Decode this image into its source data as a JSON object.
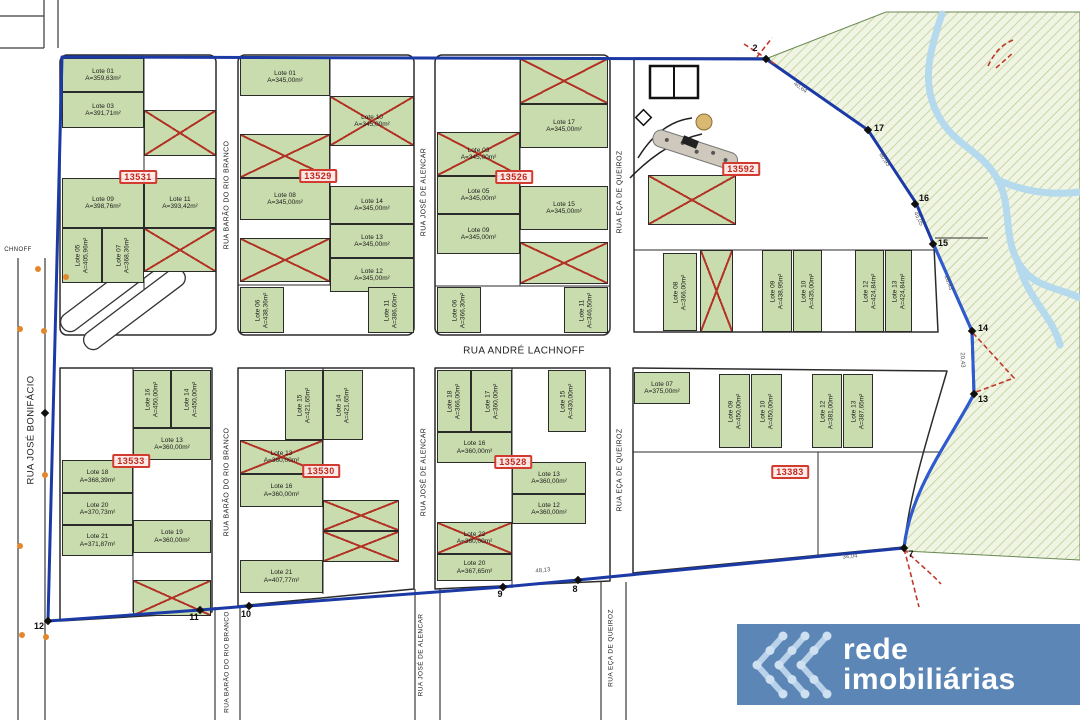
{
  "map": {
    "colors": {
      "boundary_blue": "#1b3aa6",
      "boundary_blue_bright": "#2e5bd0",
      "lot_green": "#c9dcad",
      "cross_red": "#b23326",
      "tag_red": "#d23b2f",
      "hatch_bg": "#f0f4e3",
      "hatch_line": "#bccf96",
      "river_blue": "#b5d9ed",
      "logo_bg": "#5b86b6",
      "logo_chevron": "#b9d2ea",
      "dot_orange": "#e2882a"
    },
    "streets": [
      "RUA JOSÉ BONIFÁCIO",
      "RUA BARÃO DO RIO BRANCO",
      "RUA JOSÉ DE ALENCAR",
      "RUA EÇA DE QUEIROZ",
      "RUA ANDRÉ LACHNOFF"
    ],
    "street_labels": [
      {
        "t": "RUA BARÃO DO RIO BRANCO",
        "x": 227,
        "y": 195,
        "v": true,
        "s": 7
      },
      {
        "t": "RUA BARÃO DO RIO BRANCO",
        "x": 227,
        "y": 482,
        "v": true,
        "s": 7
      },
      {
        "t": "RUA BARÃO DO RIO BRANCO",
        "x": 227,
        "y": 662,
        "v": true,
        "s": 6.5
      },
      {
        "t": "RUA JOSÉ DE ALENCAR",
        "x": 424,
        "y": 192,
        "v": true,
        "s": 7
      },
      {
        "t": "RUA JOSÉ DE ALENCAR",
        "x": 424,
        "y": 472,
        "v": true,
        "s": 7
      },
      {
        "t": "RUA JOSÉ DE ALENCAR",
        "x": 421,
        "y": 655,
        "v": true,
        "s": 6.5
      },
      {
        "t": "RUA EÇA DE QUEIROZ",
        "x": 620,
        "y": 192,
        "v": true,
        "s": 7
      },
      {
        "t": "RUA EÇA DE QUEIROZ",
        "x": 620,
        "y": 470,
        "v": true,
        "s": 7
      },
      {
        "t": "RUA EÇA DE QUEIROZ",
        "x": 611,
        "y": 648,
        "v": true,
        "s": 6.5
      },
      {
        "t": "RUA JOSÉ BONIFÁCIO",
        "x": 31,
        "y": 430,
        "v": true,
        "s": 9.5
      },
      {
        "t": "RUA ANDRÉ LACHNOFF",
        "x": 524,
        "y": 351,
        "v": false,
        "s": 10
      },
      {
        "t": "CHNOFF",
        "x": 18,
        "y": 250,
        "v": false,
        "s": 6
      }
    ],
    "lots": [
      {
        "x": 62,
        "y": 58,
        "w": 82,
        "h": 34,
        "n": "Lote 01",
        "a": "A=359,63m²"
      },
      {
        "x": 62,
        "y": 92,
        "w": 82,
        "h": 36,
        "n": "Lote 03",
        "a": "A=391,71m²"
      },
      {
        "x": 144,
        "y": 110,
        "w": 72,
        "h": 46,
        "n": "",
        "a": "",
        "c": true
      },
      {
        "x": 62,
        "y": 178,
        "w": 82,
        "h": 50,
        "n": "Lote 09",
        "a": "A=398,76m²"
      },
      {
        "x": 144,
        "y": 178,
        "w": 72,
        "h": 50,
        "n": "Lote 11",
        "a": "A=393,42m²"
      },
      {
        "x": 144,
        "y": 228,
        "w": 72,
        "h": 44,
        "n": "",
        "a": "",
        "c": true
      },
      {
        "x": 62,
        "y": 228,
        "w": 40,
        "h": 55,
        "n": "Lote 05",
        "a": "A=405,96m²",
        "v": true
      },
      {
        "x": 102,
        "y": 228,
        "w": 42,
        "h": 55,
        "n": "Lote 07",
        "a": "A=368,36m²",
        "v": true
      },
      {
        "x": 240,
        "y": 58,
        "w": 90,
        "h": 38,
        "n": "Lote 01",
        "a": "A=345,00m²"
      },
      {
        "x": 330,
        "y": 96,
        "w": 84,
        "h": 50,
        "n": "Lote 10",
        "a": "A=345,00m²",
        "c": true
      },
      {
        "x": 240,
        "y": 134,
        "w": 90,
        "h": 44,
        "n": "",
        "a": "",
        "c": true
      },
      {
        "x": 240,
        "y": 178,
        "w": 90,
        "h": 42,
        "n": "Lote 08",
        "a": "A=345,00m²"
      },
      {
        "x": 330,
        "y": 186,
        "w": 84,
        "h": 38,
        "n": "Lote 14",
        "a": "A=345,00m²"
      },
      {
        "x": 330,
        "y": 224,
        "w": 84,
        "h": 34,
        "n": "Lote 13",
        "a": "A=345,00m²"
      },
      {
        "x": 330,
        "y": 258,
        "w": 84,
        "h": 34,
        "n": "Lote 12",
        "a": "A=345,00m²"
      },
      {
        "x": 240,
        "y": 238,
        "w": 90,
        "h": 44,
        "n": "",
        "a": "",
        "c": true
      },
      {
        "x": 240,
        "y": 287,
        "w": 44,
        "h": 46,
        "n": "Lote 06",
        "a": "A=438,36m²",
        "v": true
      },
      {
        "x": 368,
        "y": 287,
        "w": 46,
        "h": 46,
        "n": "Lote 11",
        "a": "A=386,60m²",
        "v": true
      },
      {
        "x": 520,
        "y": 58,
        "w": 88,
        "h": 46,
        "n": "",
        "a": "",
        "c": true
      },
      {
        "x": 520,
        "y": 104,
        "w": 88,
        "h": 44,
        "n": "Lote 17",
        "a": "A=345,00m²"
      },
      {
        "x": 437,
        "y": 132,
        "w": 83,
        "h": 44,
        "n": "Lote 03",
        "a": "A=345,00m²",
        "c": true
      },
      {
        "x": 520,
        "y": 186,
        "w": 88,
        "h": 44,
        "n": "Lote 15",
        "a": "A=345,00m²"
      },
      {
        "x": 437,
        "y": 176,
        "w": 83,
        "h": 38,
        "n": "Lote 05",
        "a": "A=345,00m²"
      },
      {
        "x": 437,
        "y": 214,
        "w": 83,
        "h": 40,
        "n": "Lote 09",
        "a": "A=345,00m²"
      },
      {
        "x": 520,
        "y": 242,
        "w": 88,
        "h": 42,
        "n": "",
        "a": "",
        "c": true
      },
      {
        "x": 437,
        "y": 287,
        "w": 44,
        "h": 46,
        "n": "Lote 06",
        "a": "A=366,30m²",
        "v": true
      },
      {
        "x": 564,
        "y": 287,
        "w": 44,
        "h": 46,
        "n": "Lote 11",
        "a": "A=346,50m²",
        "v": true
      },
      {
        "x": 648,
        "y": 175,
        "w": 88,
        "h": 50,
        "n": "",
        "a": "",
        "c": true
      },
      {
        "x": 663,
        "y": 253,
        "w": 34,
        "h": 78,
        "n": "Lote 08",
        "a": "A=366,00m²",
        "v": true
      },
      {
        "x": 700,
        "y": 250,
        "w": 33,
        "h": 82,
        "n": "",
        "a": "",
        "c": true
      },
      {
        "x": 762,
        "y": 250,
        "w": 30,
        "h": 82,
        "n": "Lote 09",
        "a": "A=438,95m²",
        "v": true
      },
      {
        "x": 793,
        "y": 250,
        "w": 29,
        "h": 82,
        "n": "Lote 10",
        "a": "A=435,00m²",
        "v": true
      },
      {
        "x": 855,
        "y": 250,
        "w": 29,
        "h": 82,
        "n": "Lote 12",
        "a": "A=424,84m²",
        "v": true
      },
      {
        "x": 885,
        "y": 250,
        "w": 27,
        "h": 82,
        "n": "Lote 13",
        "a": "A=424,84m²",
        "v": true
      },
      {
        "x": 133,
        "y": 370,
        "w": 38,
        "h": 58,
        "n": "Lote 16",
        "a": "A=450,00m²",
        "v": true
      },
      {
        "x": 171,
        "y": 370,
        "w": 40,
        "h": 58,
        "n": "Lote 14",
        "a": "A=450,00m²",
        "v": true
      },
      {
        "x": 133,
        "y": 428,
        "w": 78,
        "h": 32,
        "n": "Lote 13",
        "a": "A=360,00m²"
      },
      {
        "x": 62,
        "y": 460,
        "w": 71,
        "h": 33,
        "n": "Lote 18",
        "a": "A=368,39m²"
      },
      {
        "x": 62,
        "y": 493,
        "w": 71,
        "h": 32,
        "n": "Lote 20",
        "a": "A=370,73m²"
      },
      {
        "x": 62,
        "y": 525,
        "w": 71,
        "h": 31,
        "n": "Lote 21",
        "a": "A=371,87m²"
      },
      {
        "x": 133,
        "y": 520,
        "w": 78,
        "h": 33,
        "n": "Lote 19",
        "a": "A=360,00m²"
      },
      {
        "x": 133,
        "y": 580,
        "w": 78,
        "h": 36,
        "n": "",
        "a": "",
        "c": true
      },
      {
        "x": 285,
        "y": 370,
        "w": 38,
        "h": 70,
        "n": "Lote 15",
        "a": "A=421,65m²",
        "v": true
      },
      {
        "x": 323,
        "y": 370,
        "w": 40,
        "h": 70,
        "n": "Lote 14",
        "a": "A=421,65m²",
        "v": true
      },
      {
        "x": 240,
        "y": 440,
        "w": 83,
        "h": 34,
        "n": "Lote 13",
        "a": "A=360,00m²",
        "c": true
      },
      {
        "x": 240,
        "y": 474,
        "w": 83,
        "h": 33,
        "n": "Lote 16",
        "a": "A=360,00m²"
      },
      {
        "x": 323,
        "y": 500,
        "w": 76,
        "h": 31,
        "n": "",
        "a": "",
        "c": true
      },
      {
        "x": 323,
        "y": 531,
        "w": 76,
        "h": 31,
        "n": "",
        "a": "",
        "c": true
      },
      {
        "x": 240,
        "y": 560,
        "w": 83,
        "h": 33,
        "n": "Lote 21",
        "a": "A=407,77m²"
      },
      {
        "x": 437,
        "y": 370,
        "w": 34,
        "h": 62,
        "n": "Lote 18",
        "a": "A=366,00m²",
        "v": true
      },
      {
        "x": 471,
        "y": 370,
        "w": 41,
        "h": 62,
        "n": "Lote 17",
        "a": "A=360,00m²",
        "v": true
      },
      {
        "x": 548,
        "y": 370,
        "w": 38,
        "h": 62,
        "n": "Lote 15",
        "a": "A=430,00m²",
        "v": true
      },
      {
        "x": 437,
        "y": 432,
        "w": 75,
        "h": 31,
        "n": "Lote 16",
        "a": "A=360,00m²"
      },
      {
        "x": 512,
        "y": 462,
        "w": 74,
        "h": 32,
        "n": "Lote 13",
        "a": "A=360,00m²"
      },
      {
        "x": 512,
        "y": 494,
        "w": 74,
        "h": 30,
        "n": "Lote 12",
        "a": "A=360,00m²"
      },
      {
        "x": 437,
        "y": 522,
        "w": 75,
        "h": 32,
        "n": "Lote 22",
        "a": "A=360,00m²",
        "c": true
      },
      {
        "x": 437,
        "y": 554,
        "w": 75,
        "h": 27,
        "n": "Lote 20",
        "a": "A=367,65m²"
      },
      {
        "x": 634,
        "y": 372,
        "w": 56,
        "h": 32,
        "n": "Lote 07",
        "a": "A=375,00m²"
      },
      {
        "x": 719,
        "y": 374,
        "w": 31,
        "h": 74,
        "n": "Lote 09",
        "a": "A=450,00m²",
        "v": true
      },
      {
        "x": 751,
        "y": 374,
        "w": 31,
        "h": 74,
        "n": "Lote 10",
        "a": "A=450,00m²",
        "v": true
      },
      {
        "x": 812,
        "y": 374,
        "w": 30,
        "h": 74,
        "n": "Lote 12",
        "a": "A=381,00m²",
        "v": true
      },
      {
        "x": 843,
        "y": 374,
        "w": 30,
        "h": 74,
        "n": "Lote 13",
        "a": "A=387,65m²",
        "v": true
      }
    ],
    "tags": [
      {
        "t": "13531",
        "x": 138,
        "y": 177
      },
      {
        "t": "13529",
        "x": 318,
        "y": 176
      },
      {
        "t": "13526",
        "x": 514,
        "y": 177
      },
      {
        "t": "13592",
        "x": 741,
        "y": 169
      },
      {
        "t": "13533",
        "x": 131,
        "y": 461
      },
      {
        "t": "13530",
        "x": 321,
        "y": 471
      },
      {
        "t": "13528",
        "x": 513,
        "y": 462
      },
      {
        "t": "13383",
        "x": 790,
        "y": 472
      }
    ],
    "vertices": [
      {
        "n": "2",
        "mx": 766,
        "my": 59,
        "lx": 755,
        "ly": 48
      },
      {
        "n": "17",
        "mx": 868,
        "my": 130,
        "lx": 879,
        "ly": 128
      },
      {
        "n": "16",
        "mx": 915,
        "my": 204,
        "lx": 924,
        "ly": 198
      },
      {
        "n": "15",
        "mx": 933,
        "my": 244,
        "lx": 943,
        "ly": 243
      },
      {
        "n": "14",
        "mx": 972,
        "my": 331,
        "lx": 983,
        "ly": 328
      },
      {
        "n": "13",
        "mx": 974,
        "my": 394,
        "lx": 983,
        "ly": 399
      },
      {
        "n": "7",
        "mx": 904,
        "my": 548,
        "lx": 911,
        "ly": 554
      },
      {
        "n": "8",
        "mx": 578,
        "my": 580,
        "lx": 575,
        "ly": 589
      },
      {
        "n": "9",
        "mx": 503,
        "my": 587,
        "lx": 500,
        "ly": 594
      },
      {
        "n": "10",
        "mx": 249,
        "my": 606,
        "lx": 246,
        "ly": 614
      },
      {
        "n": "11",
        "mx": 200,
        "my": 610,
        "lx": 194,
        "ly": 617
      },
      {
        "n": "12",
        "mx": 48,
        "my": 621,
        "lx": 39,
        "ly": 626
      },
      {
        "n": "",
        "mx": 45,
        "my": 413,
        "lx": 0,
        "ly": 0
      }
    ],
    "dims": [
      {
        "t": "40,64",
        "x": 800,
        "y": 88,
        "r": 36
      },
      {
        "t": "60,93",
        "x": 884,
        "y": 160,
        "r": 56
      },
      {
        "t": "45,05",
        "x": 918,
        "y": 219,
        "r": 64
      },
      {
        "t": "28,43",
        "x": 948,
        "y": 283,
        "r": 70
      },
      {
        "t": "20,43",
        "x": 962,
        "y": 360,
        "r": 87
      },
      {
        "t": "34,04",
        "x": 850,
        "y": 557,
        "r": -5
      },
      {
        "t": "48,13",
        "x": 543,
        "y": 571,
        "r": -6
      }
    ],
    "dots": [
      [
        38,
        269
      ],
      [
        66,
        277
      ],
      [
        20,
        329
      ],
      [
        44,
        331
      ],
      [
        45,
        475
      ],
      [
        20,
        546
      ],
      [
        22,
        635
      ],
      [
        46,
        637
      ]
    ],
    "logo": {
      "line1": "rede",
      "line2": "imobiliárias"
    }
  }
}
